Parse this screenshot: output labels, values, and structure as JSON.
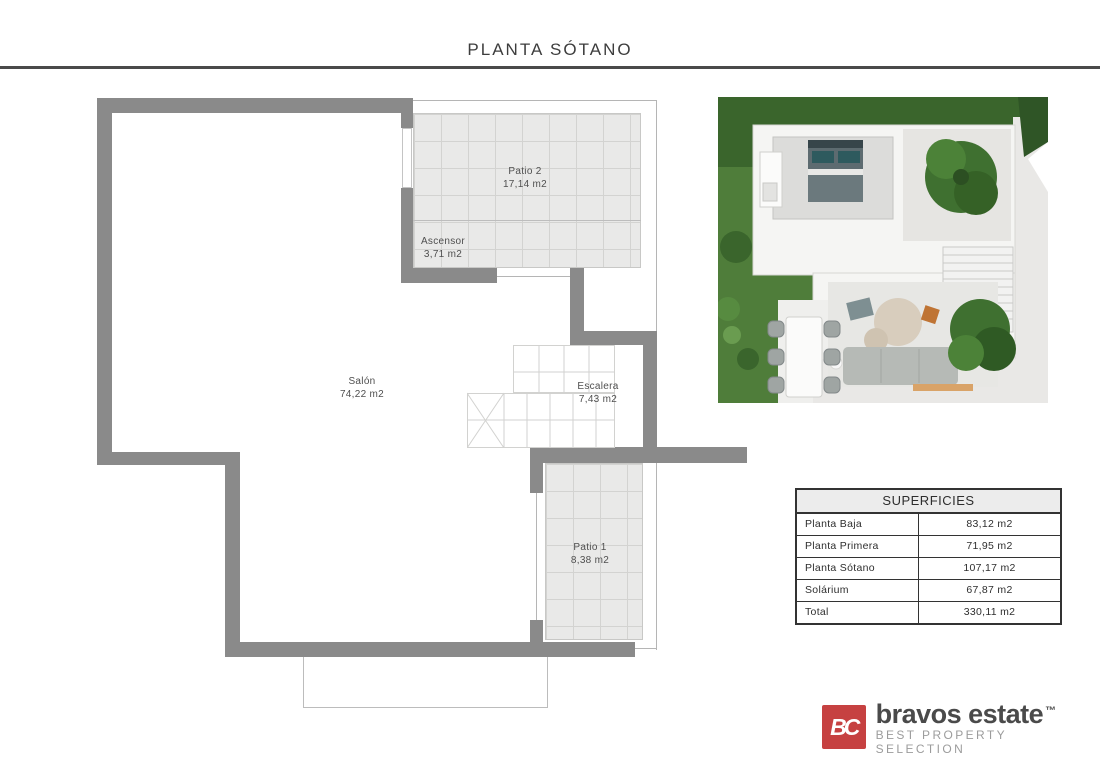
{
  "page": {
    "title": "PLANTA SÓTANO"
  },
  "floor_plan": {
    "rooms": [
      {
        "name": "Patio 2",
        "area": "17,14 m2"
      },
      {
        "name": "Ascensor",
        "area": "3,71 m2"
      },
      {
        "name": "Salón",
        "area": "74,22 m2"
      },
      {
        "name": "Escalera",
        "area": "7,43 m2"
      },
      {
        "name": "Patio 1",
        "area": "8,38 m2"
      }
    ]
  },
  "surfaces_table": {
    "title": "SUPERFICIES",
    "rows": [
      {
        "label": "Planta Baja",
        "value": "83,12 m2"
      },
      {
        "label": "Planta Primera",
        "value": "71,95 m2"
      },
      {
        "label": "Planta Sótano",
        "value": "107,17 m2"
      },
      {
        "label": "Solárium",
        "value": "67,87 m2"
      },
      {
        "label": "Total",
        "value": "330,11 m2"
      }
    ]
  },
  "brand": {
    "monogram": "BC",
    "name": "bravos estate",
    "trademark": "™",
    "tagline": "BEST PROPERTY SELECTION"
  },
  "colors": {
    "brand_red": "#c64141",
    "wall_gray": "#8a8a8a",
    "grass_green": "#4f7d3a",
    "tile_gray": "#e9e9e8"
  }
}
